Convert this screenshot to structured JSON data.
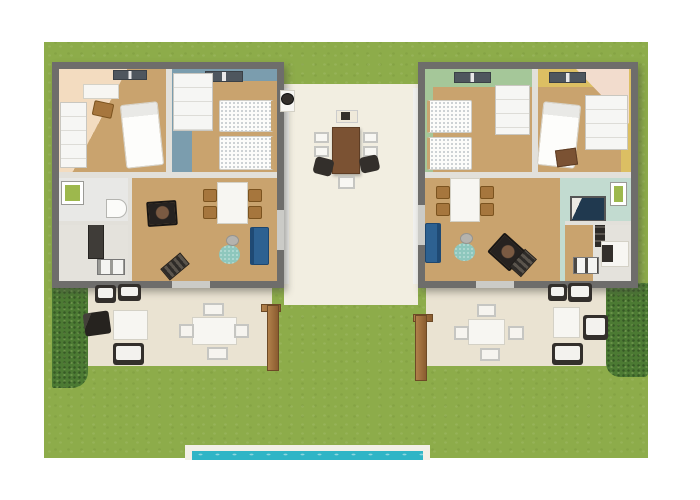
{
  "meta": {
    "title": "3D floor plan rendering of two mirrored holiday units with garden and pool",
    "view": "top-down aerial 3D render",
    "visible_text": "none"
  },
  "colors": {
    "page_bg": "#ffffff",
    "lawn": "#8dac4a",
    "hedge": "#4c7a33",
    "wall": "#6e6d6b",
    "wood": "#c9a36e",
    "courtyard_floor": "#f2eee1",
    "patio_floor": "#eae3d2",
    "peach": "#f3dcc0",
    "blue": "#7b9dae",
    "green": "#a5c799",
    "yellow": "#dcbf63",
    "mint": "#c2dbd0",
    "pool_water": "#2fb5c6",
    "pool_deck": "#f2efe6",
    "sofa": "#2d6191",
    "rug": "#8ec7bd",
    "table_wood": "#7b5233",
    "chair_wood": "#a6763d",
    "dark": "#332f2b",
    "white_furniture": "#f7f6f2",
    "metal": "#c6c6c2",
    "post": "#9a6c3e",
    "navy": "#20394f",
    "picture_green": "#9db84d"
  },
  "scene": {
    "left_unit": {
      "rooms": [
        "peach double bedroom",
        "blue twin bedroom",
        "bathroom",
        "kitchen",
        "living-dining room"
      ],
      "furniture": [
        "double bed",
        "desk with chair",
        "two wardrobes",
        "two twin beds",
        "skylights",
        "white dining table with four wooden chairs",
        "wood stove",
        "blue sofa",
        "round teal rug",
        "round side table",
        "green-framed mirror",
        "toilet",
        "kitchen counter",
        "double sink",
        "striped doormat"
      ]
    },
    "right_unit": {
      "rooms": [
        "green twin bedroom",
        "yellow double bedroom",
        "bathroom with shower",
        "kitchen",
        "living-dining room"
      ],
      "furniture": [
        "two twin beds",
        "double bed",
        "wardrobe",
        "cabinet",
        "dressing desk",
        "skylights",
        "white dining table with four wooden chairs",
        "wood stove",
        "blue sofa",
        "round teal rug",
        "round side table",
        "navy shower",
        "green-framed mirror",
        "oven column",
        "kitchen counter",
        "double sink",
        "striped doormat"
      ]
    },
    "courtyard": {
      "furniture": [
        "barbecue grill",
        "console table",
        "long wooden dining table",
        "five metal chairs",
        "two occupied dark chairs"
      ]
    },
    "front_patio": {
      "left": [
        "two lounge armchairs with white cushions",
        "white coffee table",
        "barbecue",
        "white dining table with four metal chairs"
      ],
      "right": [
        "four lounge armchairs with white cushions",
        "white coffee table",
        "white dining table with four metal chairs"
      ],
      "features": [
        "two wooden pergola posts",
        "door openings"
      ]
    },
    "garden": {
      "features": [
        "large lawn",
        "left hedge",
        "right hedge",
        "swimming pool with white deck at bottom edge"
      ]
    }
  }
}
